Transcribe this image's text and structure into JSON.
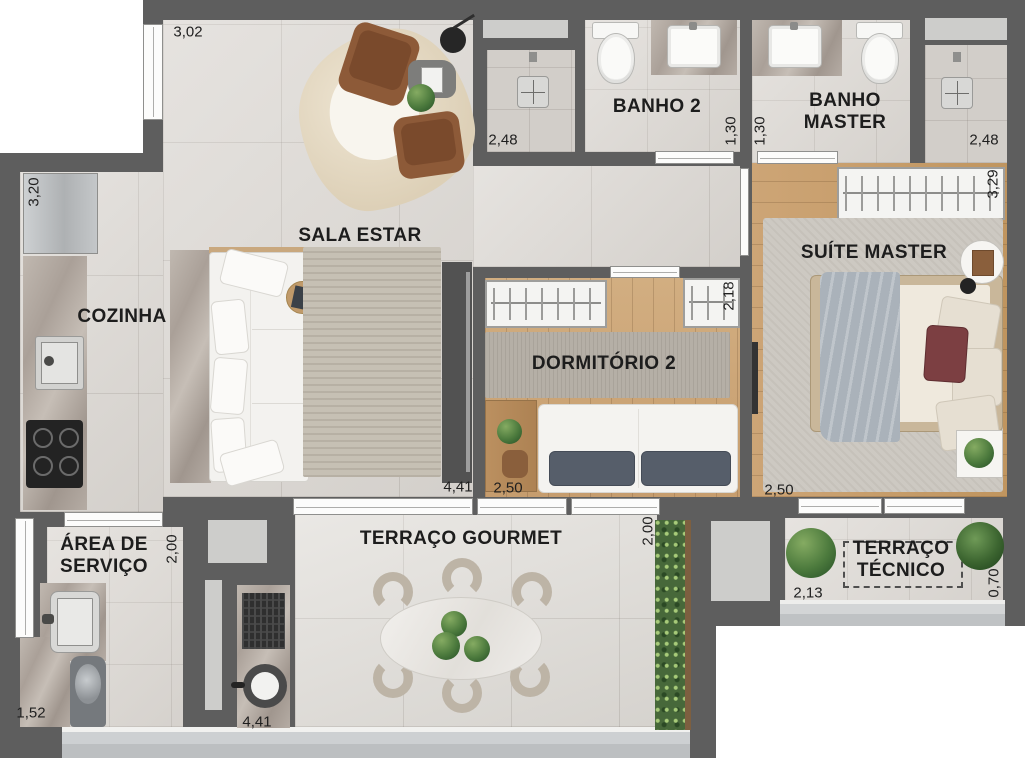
{
  "palette": {
    "wall": "#5e5e5e",
    "floor_tile": "#dcd8d3",
    "wood_floor": "#c9a173",
    "fixture_white": "#f8f8f6",
    "accent_green": "#4c7a3d",
    "text": "#1d1d1d"
  },
  "rooms": {
    "sala_estar": {
      "label": "SALA ESTAR"
    },
    "cozinha": {
      "label": "COZINHA"
    },
    "banho_2": {
      "label": "BANHO 2"
    },
    "banho_master": {
      "line1": "BANHO",
      "line2": "MASTER"
    },
    "suite_master": {
      "label": "SUÍTE MASTER"
    },
    "dormitorio_2": {
      "label": "DORMITÓRIO 2"
    },
    "area_servico": {
      "line1": "ÁREA DE",
      "line2": "SERVIÇO"
    },
    "terraco_gourmet": {
      "label": "TERRAÇO GOURMET"
    },
    "terraco_tecnico": {
      "line1": "TERRAÇO",
      "line2": "TÉCNICO"
    }
  },
  "dimensions": {
    "sala_top_width": "3,02",
    "banho2_shower_width": "2,48",
    "banho2_depth": "1,30",
    "banho_master_depth": "1,30",
    "banho_master_shower_width": "2,48",
    "cozinha_depth": "3,20",
    "suite_closet_width": "3,29",
    "dorm2_closet_width": "2,18",
    "sala_width": "4,41",
    "dorm2_width": "2,50",
    "suite_width": "2,50",
    "area_servico_depth": "2,00",
    "terraco_gourmet_depth": "2,00",
    "terraco_tecnico_width": "2,13",
    "terraco_tecnico_depth": "0,70",
    "area_servico_width": "1,52",
    "terraco_gourmet_width": "4,41"
  }
}
